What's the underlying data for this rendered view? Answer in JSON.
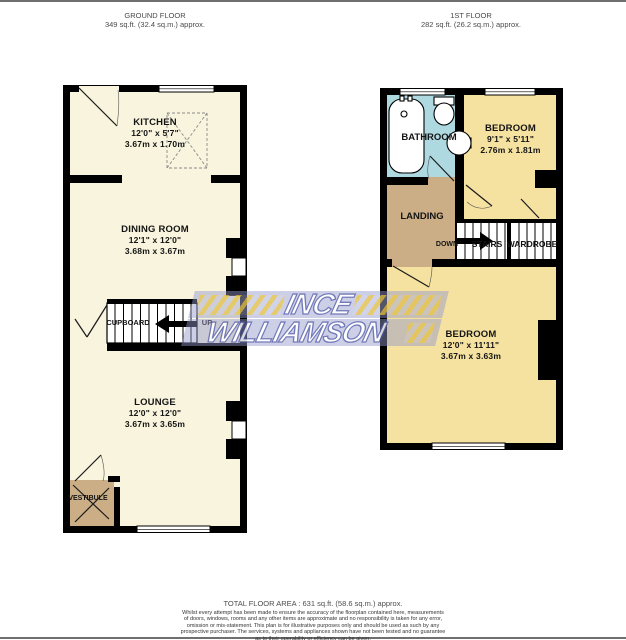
{
  "ground_floor": {
    "title": "GROUND FLOOR",
    "area": "349 sq.ft. (32.4 sq.m.) approx.",
    "rooms": {
      "kitchen": {
        "name": "KITCHEN",
        "dims_imperial": "12'0\" x 5'7\"",
        "dims_metric": "3.67m x 1.70m"
      },
      "dining": {
        "name": "DINING ROOM",
        "dims_imperial": "12'1\" x 12'0\"",
        "dims_metric": "3.68m x 3.67m"
      },
      "lounge": {
        "name": "LOUNGE",
        "dims_imperial": "12'0\" x 12'0\"",
        "dims_metric": "3.67m x 3.65m"
      },
      "cupboard": {
        "name": "CUPBOARD"
      },
      "vestibule": {
        "name": "VESTIBULE"
      },
      "stairs_direction": "UP"
    }
  },
  "first_floor": {
    "title": "1ST FLOOR",
    "area": "282 sq.ft. (26.2 sq.m.) approx.",
    "rooms": {
      "bathroom": {
        "name": "BATHROOM"
      },
      "bedroom1": {
        "name": "BEDROOM",
        "dims_imperial": "9'1\" x 5'11\"",
        "dims_metric": "2.76m x 1.81m"
      },
      "landing": {
        "name": "LANDING"
      },
      "stairs": {
        "name": "STAIRS"
      },
      "wardrobe": {
        "name": "WARDROBE"
      },
      "bedroom2": {
        "name": "BEDROOM",
        "dims_imperial": "12'0\" x 11'11\"",
        "dims_metric": "3.67m x 3.63m"
      },
      "stairs_direction": "DOWN"
    }
  },
  "watermark": {
    "line1": "INCE",
    "line2": "WILLIAMSON"
  },
  "footer": {
    "total_area": "TOTAL FLOOR AREA : 631 sq.ft. (58.6 sq.m.) approx.",
    "disclaimer_lines": [
      "Whilst every attempt has been made to ensure the accuracy of the floorplan contained here, measurements",
      "of doors, windows, rooms and any other items are approximate and no responsibility is taken for any error,",
      "omission or mis-statement. This plan is for illustrative purposes only and should be used as such by any",
      "prospective purchaser. The services, systems and appliances shown have not been tested and no guarantee",
      "as to their operability or efficiency can be given."
    ],
    "credit": "Made with Metropix ©2025"
  },
  "colors": {
    "wall": "#000000",
    "ground_floor_room": "#F8F4DE",
    "hall_tan": "#CBAE86",
    "bathroom_blue": "#AED9E0",
    "bedroom_yellow": "#F5E1A0",
    "logo_band": "#9298CB",
    "logo_stripe": "#E3C14C",
    "logo_text_outline": "#5B64AD"
  }
}
